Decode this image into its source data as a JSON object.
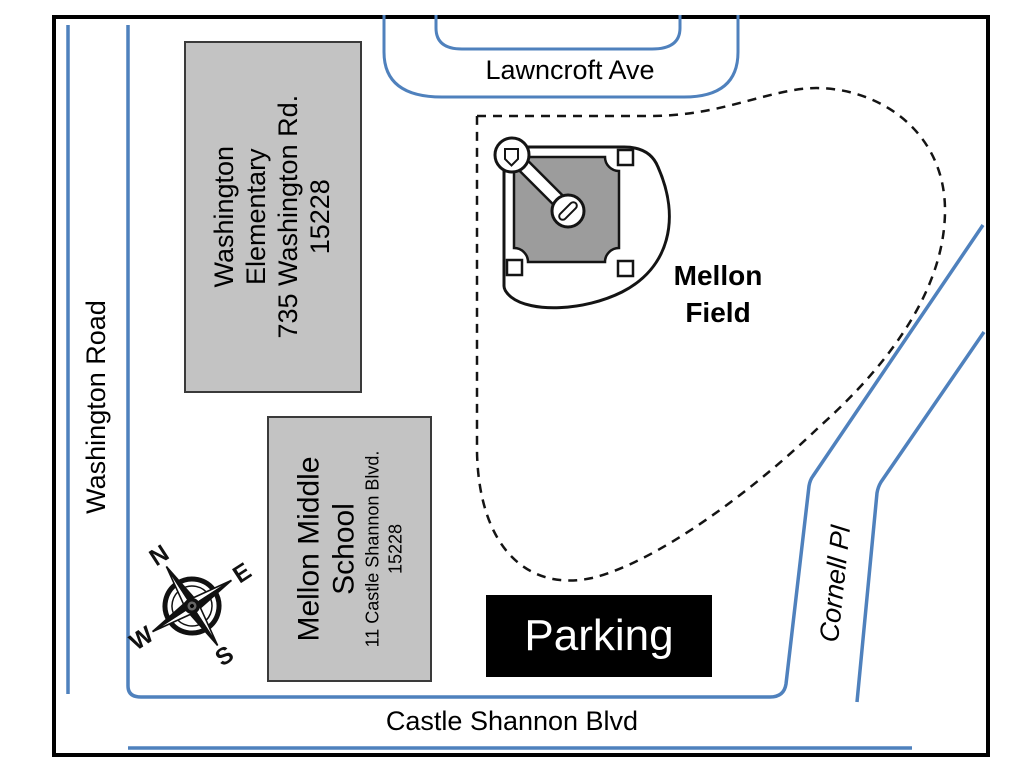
{
  "streets": {
    "washington_road": "Washington Road",
    "lawncroft_ave": "Lawncroft Ave",
    "castle_shannon_blvd": "Castle Shannon Blvd",
    "cornell_pl": "Cornell Pl"
  },
  "buildings": {
    "washington_elementary": {
      "name": "Washington Elementary",
      "address": "735 Washington Rd.",
      "zip": "15228"
    },
    "mellon_middle": {
      "name": "Mellon Middle School",
      "address": "11 Castle Shannon Blvd.",
      "zip": "15228"
    }
  },
  "field": {
    "line1": "Mellon",
    "line2": "Field"
  },
  "parking": {
    "label": "Parking"
  },
  "compass": {
    "n": "N",
    "e": "E",
    "s": "S",
    "w": "W"
  },
  "colors": {
    "road_blue": "#4f81bd",
    "building_fill": "#c3c3c3",
    "building_border": "#3a3a3a",
    "infield_gray": "#9c9c9c",
    "ink": "#141414",
    "parking_bg": "#000000",
    "parking_fg": "#ffffff"
  }
}
